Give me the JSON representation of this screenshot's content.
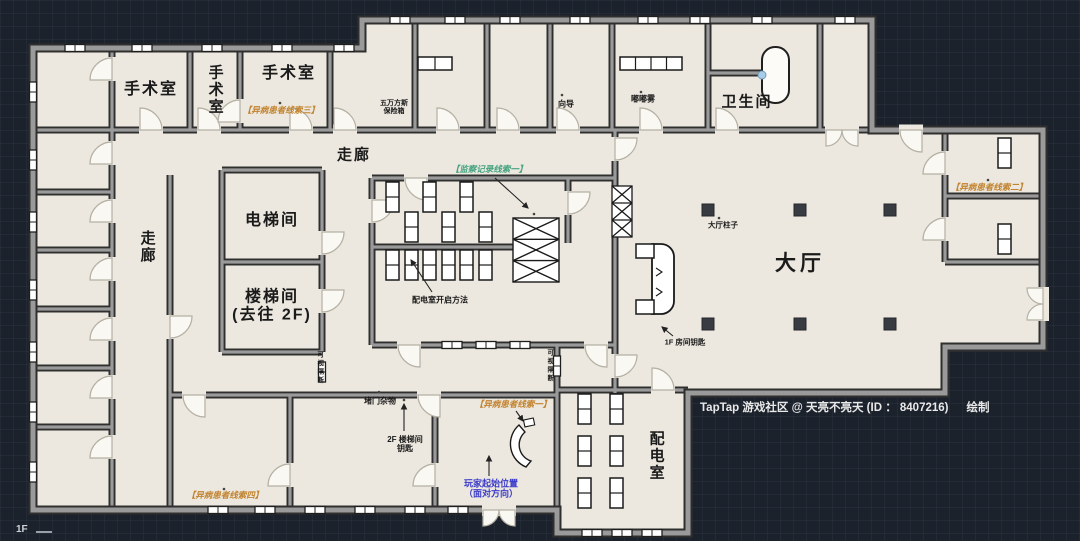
{
  "floor_plan": {
    "floor_marker": "1F",
    "rooms": {
      "or1": "手术室",
      "or2": "手术室",
      "or3": "手术室",
      "corridor_top": "走廊",
      "corridor_left": "走廊",
      "elevator": "电梯间",
      "stairs_line1": "楼梯间",
      "stairs_line2": "(去往 2F)",
      "bathroom": "卫生间",
      "hall": "大厅",
      "power_room": "配电室"
    },
    "labels": {
      "safe_line1": "五万方斯",
      "safe_line2": "保险箱",
      "guide": "向导",
      "fog": "嘟嘟雾",
      "hall_pillar": "大厅柱子",
      "f1_room_key": "1F 房间钥匙",
      "power_room_method": "配电室开启方法",
      "partition_left": "可视隔断",
      "partition_right": "可视隔断",
      "door_clutter": "堵门杂物",
      "f2_stair_key_line1": "2F 楼梯间",
      "f2_stair_key_line2": "钥匙"
    },
    "clues": {
      "surveillance_1": "【监察记录线索一】",
      "patient_1": "【异病患者线索一】",
      "patient_2": "【异病患者线索二】",
      "patient_3": "【异病患者线索三】",
      "patient_4": "【异病患者线索四】",
      "player_start_line1": "玩家起始位置",
      "player_start_line2": "（面对方向）"
    },
    "footer": {
      "credit": "TapTap 游戏社区 @ 天亮不亮天 (ID ： 8407216)",
      "suffix": "绘制"
    },
    "colors": {
      "background": "#1c222c",
      "floor": "#ece8df",
      "wall": "#9a9a9a",
      "wall_edge": "#2f2f2f",
      "clue_orange": "#c2832f",
      "clue_green": "#46a381",
      "player_blue": "#3c3ccc",
      "text_dark": "#1a1a1a",
      "footer_text": "#e9e9e9"
    }
  }
}
